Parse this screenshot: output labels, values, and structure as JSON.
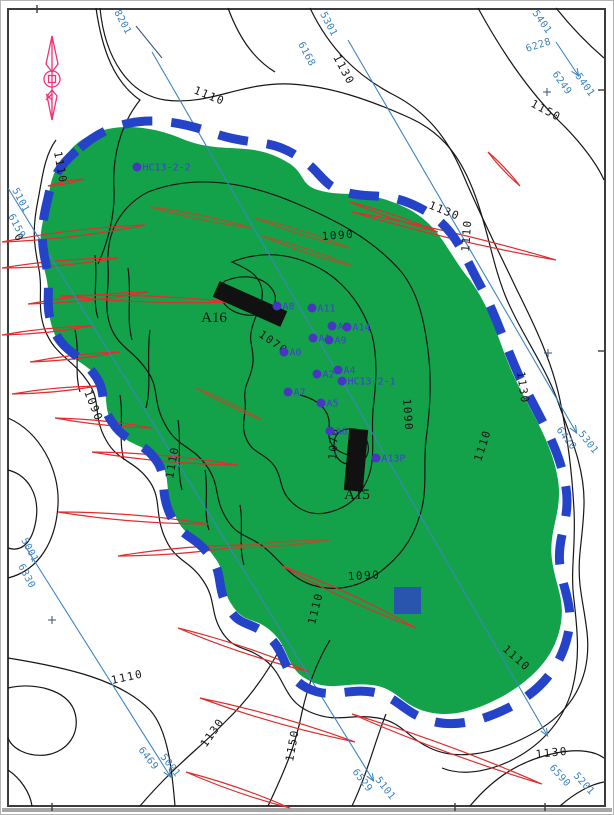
{
  "map": {
    "kind": "oil-field-structure-contour-map",
    "colors": {
      "field_fill": "#13a24a",
      "boundary_blue": "#2443c8",
      "contour_black": "#161616",
      "fault_red": "#e02e2e",
      "fault_brown": "#9c5a30",
      "seismic_blue": "#3c84c4",
      "well_dot": "#4a35c2",
      "well_label": "#4040d0",
      "platform_black": "#111111",
      "facility_blue": "#2a55ae",
      "north_arrow_pink": "#ee3377"
    },
    "wells": [
      {
        "name": "HC13-2-2",
        "x": 137,
        "y": 167
      },
      {
        "name": "A8",
        "x": 277,
        "y": 306
      },
      {
        "name": "A11",
        "x": 312,
        "y": 308
      },
      {
        "name": "A3",
        "x": 332,
        "y": 326
      },
      {
        "name": "A14",
        "x": 347,
        "y": 327
      },
      {
        "name": "A1",
        "x": 313,
        "y": 338
      },
      {
        "name": "A9",
        "x": 329,
        "y": 340
      },
      {
        "name": "A0",
        "x": 284,
        "y": 352
      },
      {
        "name": "A2",
        "x": 317,
        "y": 374
      },
      {
        "name": "A4",
        "x": 338,
        "y": 370
      },
      {
        "name": "HC13-2-1",
        "x": 342,
        "y": 381
      },
      {
        "name": "A7",
        "x": 288,
        "y": 392
      },
      {
        "name": "A5",
        "x": 321,
        "y": 403
      },
      {
        "name": "A6",
        "x": 330,
        "y": 431
      },
      {
        "name": "A13P",
        "x": 376,
        "y": 458
      }
    ],
    "platforms": [
      {
        "name": "A16",
        "cx": 250,
        "cy": 304,
        "w": 74,
        "h": 17,
        "rot": 24,
        "lx": 214,
        "ly": 322
      },
      {
        "name": "A15",
        "cx": 356,
        "cy": 460,
        "w": 19,
        "h": 62,
        "rot": 5,
        "lx": 357,
        "ly": 499
      }
    ],
    "facility": {
      "x": 394,
      "y": 587,
      "size": 27
    },
    "contour_labels": [
      {
        "text": "1110",
        "x": 193,
        "y": 93,
        "r": 22
      },
      {
        "text": "1130",
        "x": 333,
        "y": 57,
        "r": 62
      },
      {
        "text": "1150",
        "x": 530,
        "y": 106,
        "r": 28
      },
      {
        "text": "1110",
        "x": 54,
        "y": 152,
        "r": 80
      },
      {
        "text": "0",
        "x": 14,
        "y": 236,
        "r": 60
      },
      {
        "text": "1090",
        "x": 322,
        "y": 240,
        "r": -4
      },
      {
        "text": "1130",
        "x": 428,
        "y": 208,
        "r": 22
      },
      {
        "text": "1110",
        "x": 469,
        "y": 252,
        "r": -86
      },
      {
        "text": "1130",
        "x": 517,
        "y": 372,
        "r": 82
      },
      {
        "text": "1110",
        "x": 481,
        "y": 462,
        "r": -72
      },
      {
        "text": "1090",
        "x": 403,
        "y": 399,
        "r": 86
      },
      {
        "text": "1070",
        "x": 258,
        "y": 336,
        "r": 35
      },
      {
        "text": "1070",
        "x": 336,
        "y": 460,
        "r": -86
      },
      {
        "text": "1090",
        "x": 84,
        "y": 392,
        "r": 68
      },
      {
        "text": "1110",
        "x": 173,
        "y": 479,
        "r": -80
      },
      {
        "text": "1090",
        "x": 348,
        "y": 580,
        "r": -3
      },
      {
        "text": "1110",
        "x": 315,
        "y": 625,
        "r": -76
      },
      {
        "text": "1110",
        "x": 502,
        "y": 650,
        "r": 42
      },
      {
        "text": "1110",
        "x": 112,
        "y": 684,
        "r": -12
      },
      {
        "text": "1130",
        "x": 206,
        "y": 748,
        "r": -55
      },
      {
        "text": "1150",
        "x": 293,
        "y": 762,
        "r": -80
      },
      {
        "text": "1130",
        "x": 536,
        "y": 758,
        "r": -6
      }
    ],
    "seismic_labels": [
      {
        "text": "8201",
        "x": 114,
        "y": 12,
        "r": 62
      },
      {
        "text": "5301",
        "x": 320,
        "y": 14,
        "r": 62
      },
      {
        "text": "6168",
        "x": 298,
        "y": 44,
        "r": 62
      },
      {
        "text": "5401",
        "x": 532,
        "y": 13,
        "r": 55
      },
      {
        "text": "6228",
        "x": 527,
        "y": 52,
        "r": -18
      },
      {
        "text": "6249",
        "x": 552,
        "y": 74,
        "r": 55
      },
      {
        "text": "5401",
        "x": 575,
        "y": 76,
        "r": 55
      },
      {
        "text": "6420",
        "x": 556,
        "y": 430,
        "r": 52
      },
      {
        "text": "5301",
        "x": 578,
        "y": 434,
        "r": 52
      },
      {
        "text": "5101",
        "x": 12,
        "y": 190,
        "r": 62
      },
      {
        "text": "6159",
        "x": 8,
        "y": 216,
        "r": 62
      },
      {
        "text": "5001",
        "x": 21,
        "y": 540,
        "r": 62
      },
      {
        "text": "6330",
        "x": 18,
        "y": 566,
        "r": 62
      },
      {
        "text": "6469",
        "x": 138,
        "y": 750,
        "r": 52
      },
      {
        "text": "5001",
        "x": 160,
        "y": 757,
        "r": 52
      },
      {
        "text": "6529",
        "x": 352,
        "y": 772,
        "r": 52
      },
      {
        "text": "5101",
        "x": 375,
        "y": 780,
        "r": 52
      },
      {
        "text": "6590",
        "x": 549,
        "y": 768,
        "r": 48
      },
      {
        "text": "5201",
        "x": 573,
        "y": 776,
        "r": 48
      }
    ],
    "plus_marks": [
      [
        547,
        92
      ],
      [
        548,
        353
      ],
      [
        52,
        620
      ]
    ],
    "edge_ticks": [
      {
        "x": 37,
        "y": 9,
        "o": "v"
      },
      {
        "x": 602,
        "y": 90,
        "o": "h"
      },
      {
        "x": 602,
        "y": 351,
        "o": "h"
      },
      {
        "x": 52,
        "y": 807,
        "o": "v"
      },
      {
        "x": 455,
        "y": 807,
        "o": "v"
      },
      {
        "x": 545,
        "y": 807,
        "o": "v"
      }
    ]
  }
}
